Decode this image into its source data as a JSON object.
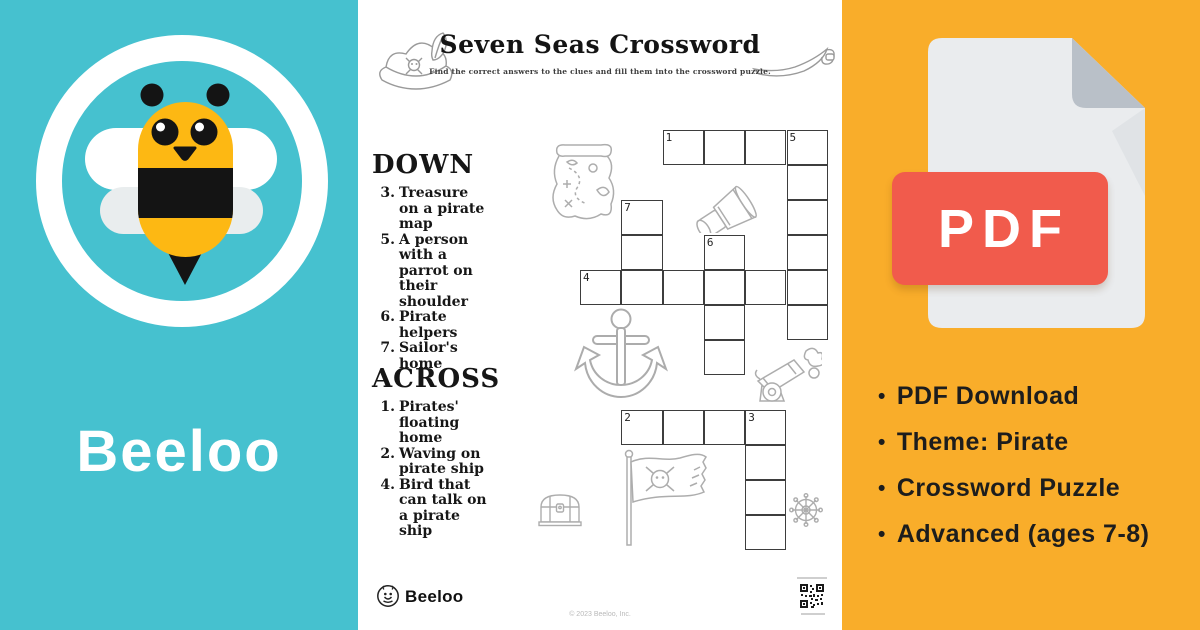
{
  "colors": {
    "teal": "#46C1CF",
    "orange": "#F9AD2A",
    "pdf_red": "#F15B4C",
    "page_gray": "#EAECEE",
    "fold_gray": "#B9C0C8",
    "ink": "#141414",
    "line_art_gray": "#ADADAD"
  },
  "left_panel": {
    "brand_name": "Beeloo",
    "icon": "bee-mascot-icon"
  },
  "worksheet": {
    "title": "Seven Seas Crossword",
    "subtitle": "Find the correct answers to the clues and fill them into the crossword puzzle.",
    "down_heading": "DOWN",
    "down_clues": [
      {
        "num": "3.",
        "text": "Treasure\non a pirate\nmap"
      },
      {
        "num": "5.",
        "text": "A person\nwith a\nparrot on\ntheir shoulder"
      },
      {
        "num": "6.",
        "text": "Pirate\nhelpers"
      },
      {
        "num": "7.",
        "text": "Sailor's\nhome"
      }
    ],
    "across_heading": "ACROSS",
    "across_clues": [
      {
        "num": "1.",
        "text": "Pirates'\nfloating\nhome"
      },
      {
        "num": "2.",
        "text": "Waving on\npirate ship"
      },
      {
        "num": "4.",
        "text": "Bird that\ncan talk on\na pirate\nship"
      }
    ],
    "footer_brand": "Beeloo",
    "copyright": "© 2023 Beeloo, Inc.",
    "decor_icons": [
      "pirate-hat-icon",
      "cutlass-icon",
      "treasure-map-icon",
      "spyglass-icon",
      "anchor-icon",
      "cannon-icon",
      "pirate-flag-icon",
      "treasure-chest-icon",
      "ship-wheel-icon",
      "qr-code-icon",
      "beeloo-logo-icon"
    ]
  },
  "crossword": {
    "origin_x": 222,
    "origin_y": 130,
    "cell_w": 41.3,
    "cell_h": 35,
    "cells": [
      {
        "r": 0,
        "c": 2,
        "n": "1"
      },
      {
        "r": 0,
        "c": 3
      },
      {
        "r": 0,
        "c": 4
      },
      {
        "r": 0,
        "c": 5,
        "n": "5"
      },
      {
        "r": 1,
        "c": 5
      },
      {
        "r": 2,
        "c": 1,
        "n": "7"
      },
      {
        "r": 2,
        "c": 5
      },
      {
        "r": 3,
        "c": 1
      },
      {
        "r": 3,
        "c": 3,
        "n": "6"
      },
      {
        "r": 3,
        "c": 5
      },
      {
        "r": 4,
        "c": 0,
        "n": "4"
      },
      {
        "r": 4,
        "c": 1
      },
      {
        "r": 4,
        "c": 2
      },
      {
        "r": 4,
        "c": 3
      },
      {
        "r": 4,
        "c": 4
      },
      {
        "r": 4,
        "c": 5
      },
      {
        "r": 5,
        "c": 3
      },
      {
        "r": 5,
        "c": 5
      },
      {
        "r": 6,
        "c": 3
      },
      {
        "r": 8,
        "c": 1,
        "n": "2"
      },
      {
        "r": 8,
        "c": 2
      },
      {
        "r": 8,
        "c": 3
      },
      {
        "r": 8,
        "c": 4,
        "n": "3"
      },
      {
        "r": 9,
        "c": 4
      },
      {
        "r": 10,
        "c": 4
      },
      {
        "r": 11,
        "c": 4
      }
    ]
  },
  "right_panel": {
    "pdf_label": "PDF",
    "icon": "pdf-file-icon",
    "bullets": [
      "PDF Download",
      "Theme: Pirate",
      "Crossword Puzzle",
      "Advanced (ages 7-8)"
    ]
  }
}
